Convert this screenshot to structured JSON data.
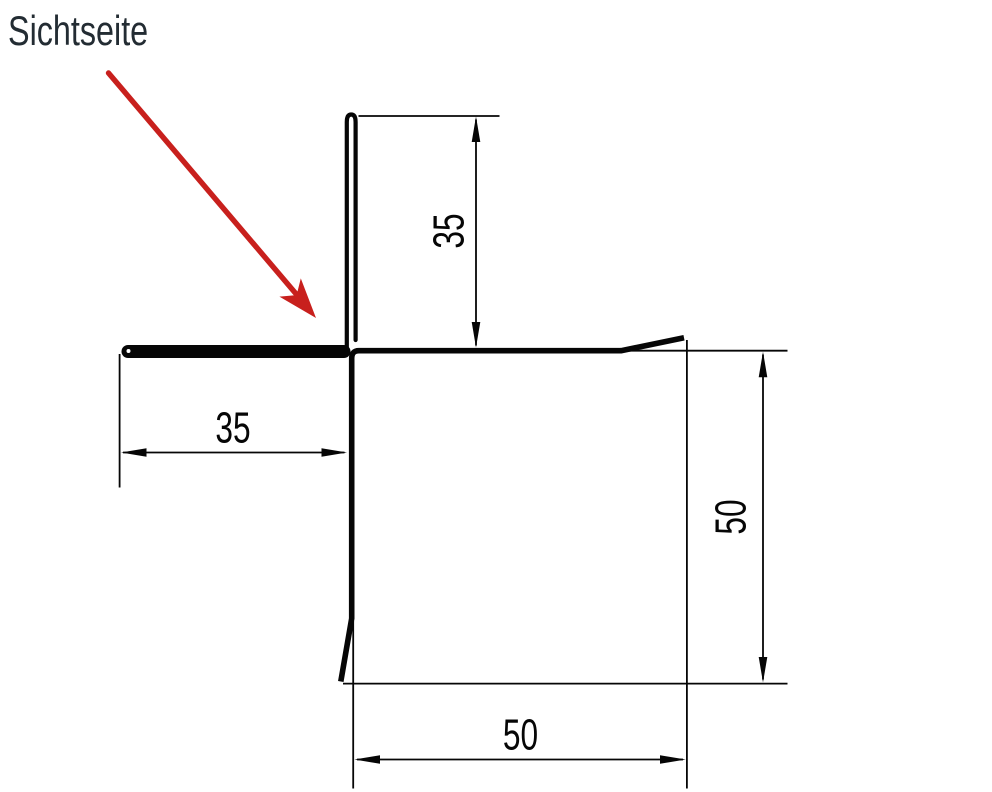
{
  "drawing": {
    "title": "Sichtseite",
    "type": "sheet-metal-corner-profile-cross-section",
    "dimensions": {
      "vertical_leg": "35",
      "visible_face": "35",
      "right_height": "50",
      "bottom_width": "50"
    },
    "colors": {
      "line": "#060606",
      "pointer_red": "#c8201d",
      "title_text": "#232c33",
      "background": "#ffffff"
    }
  }
}
